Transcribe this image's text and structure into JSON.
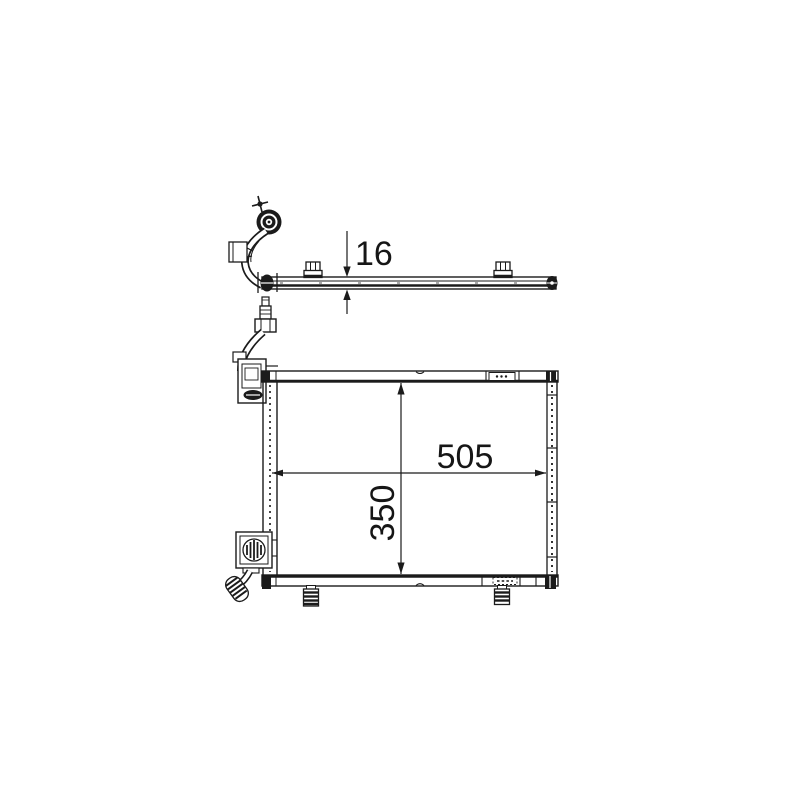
{
  "page": {
    "background_color": "#ffffff"
  },
  "drawing": {
    "line_color": "#1b1b1b",
    "label_color": "#161616",
    "dimensions": {
      "top_view_thickness": "16",
      "front_view_width": "505",
      "front_view_height": "350"
    }
  }
}
